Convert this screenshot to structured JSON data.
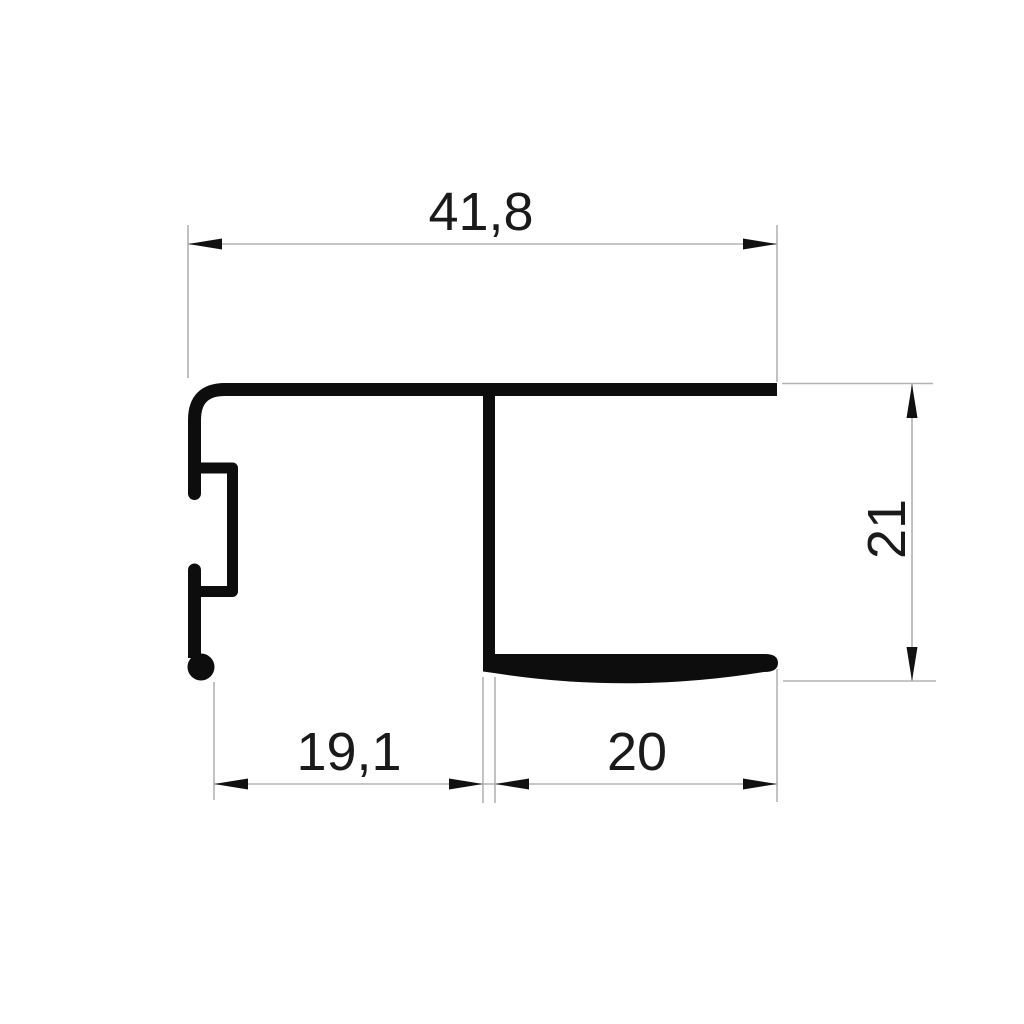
{
  "drawing": {
    "kind": "aluminum-profile-cross-section",
    "background_color": "#ffffff",
    "profile_color": "#0d0d0d",
    "dimension_line_color": "#b3b3b3",
    "arrow_color": "#111111",
    "text_color": "#1a1a1a",
    "dimensions": {
      "total_width": {
        "label": "41,8",
        "orientation": "horizontal",
        "position": "top"
      },
      "left_width": {
        "label": "19,1",
        "orientation": "horizontal",
        "position": "bottom-left"
      },
      "right_width": {
        "label": "20",
        "orientation": "horizontal",
        "position": "bottom-right"
      },
      "right_height": {
        "label": "21",
        "orientation": "vertical",
        "position": "right"
      }
    }
  }
}
